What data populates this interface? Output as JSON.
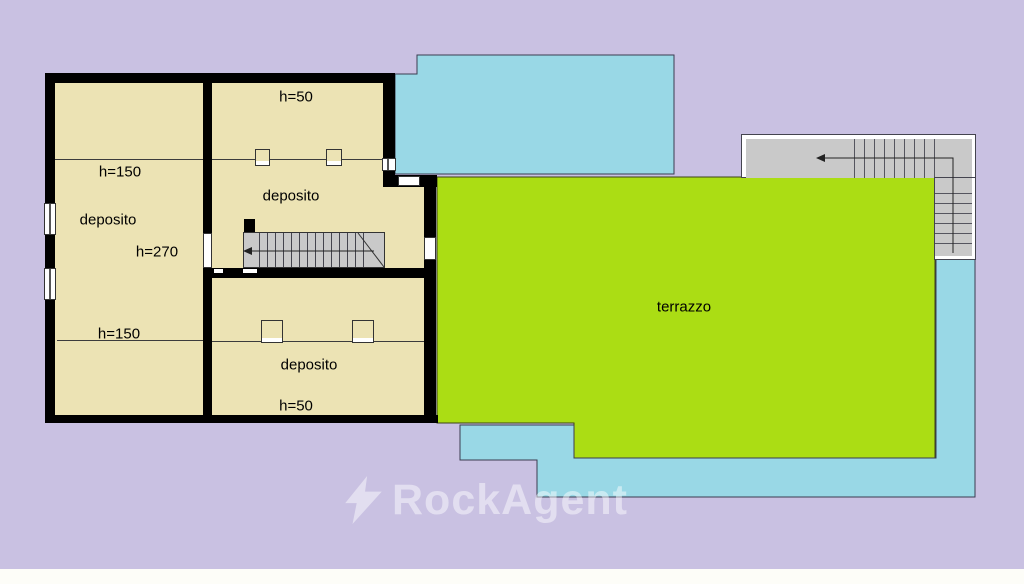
{
  "plan": {
    "left_room": {
      "name": "deposito (left)",
      "label": "deposito",
      "height_upper": "h=150",
      "height_center": "h=270",
      "height_lower": "h=150"
    },
    "upper_middle_room": {
      "name": "deposito (upper middle)",
      "label": "deposito",
      "height_top": "h=50"
    },
    "lower_middle_room": {
      "name": "deposito (lower middle)",
      "label": "deposito",
      "height_bottom": "h=50"
    },
    "terrace": {
      "label": "terrazzo"
    }
  },
  "watermark": {
    "icon": "lightning-bolt",
    "brand": "RockAgent"
  },
  "colors": {
    "background": "#c9c1e2",
    "wall": "#000000",
    "room_fill": "#ece3b4",
    "terrace_green": "#abdd14",
    "water_cyan": "#99d8e6",
    "stair_gray": "#c9c9c9",
    "outline": "#3c3c3c",
    "footer_strip": "#fdfdf8",
    "watermark_white": "rgba(255,255,255,0.47)"
  }
}
